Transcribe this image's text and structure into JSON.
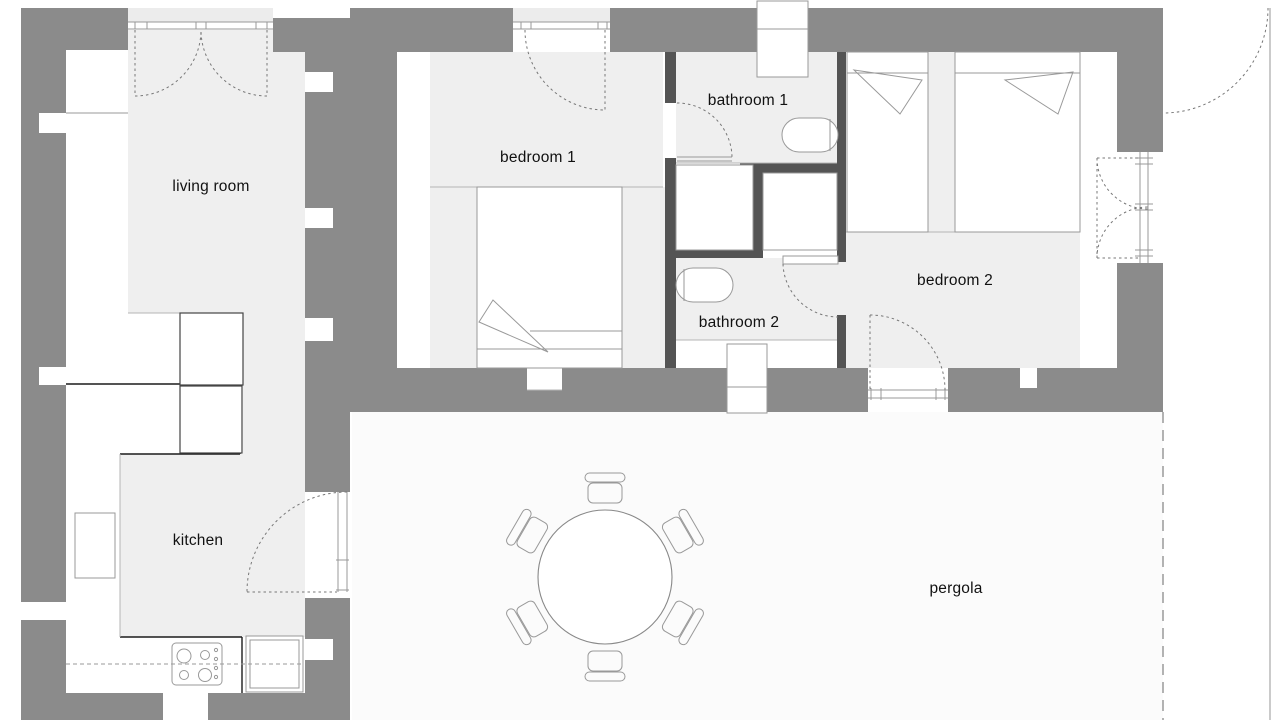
{
  "rooms": {
    "living": {
      "label": "living room"
    },
    "kitchen": {
      "label": "kitchen"
    },
    "bedroom1": {
      "label": "bedroom 1"
    },
    "bathroom1": {
      "label": "bathroom 1"
    },
    "bathroom2": {
      "label": "bathroom 2"
    },
    "bedroom2": {
      "label": "bedroom 2"
    },
    "pergola": {
      "label": "pergola"
    }
  },
  "colors": {
    "wall_exterior": "#8b8b8b",
    "wall_interior": "#545454",
    "floor": "#efefef",
    "porch": "#ececec",
    "pergola_floor": "#fbfbfb",
    "outline": "#999999",
    "dash": "#777777",
    "label_text": "#111111"
  }
}
